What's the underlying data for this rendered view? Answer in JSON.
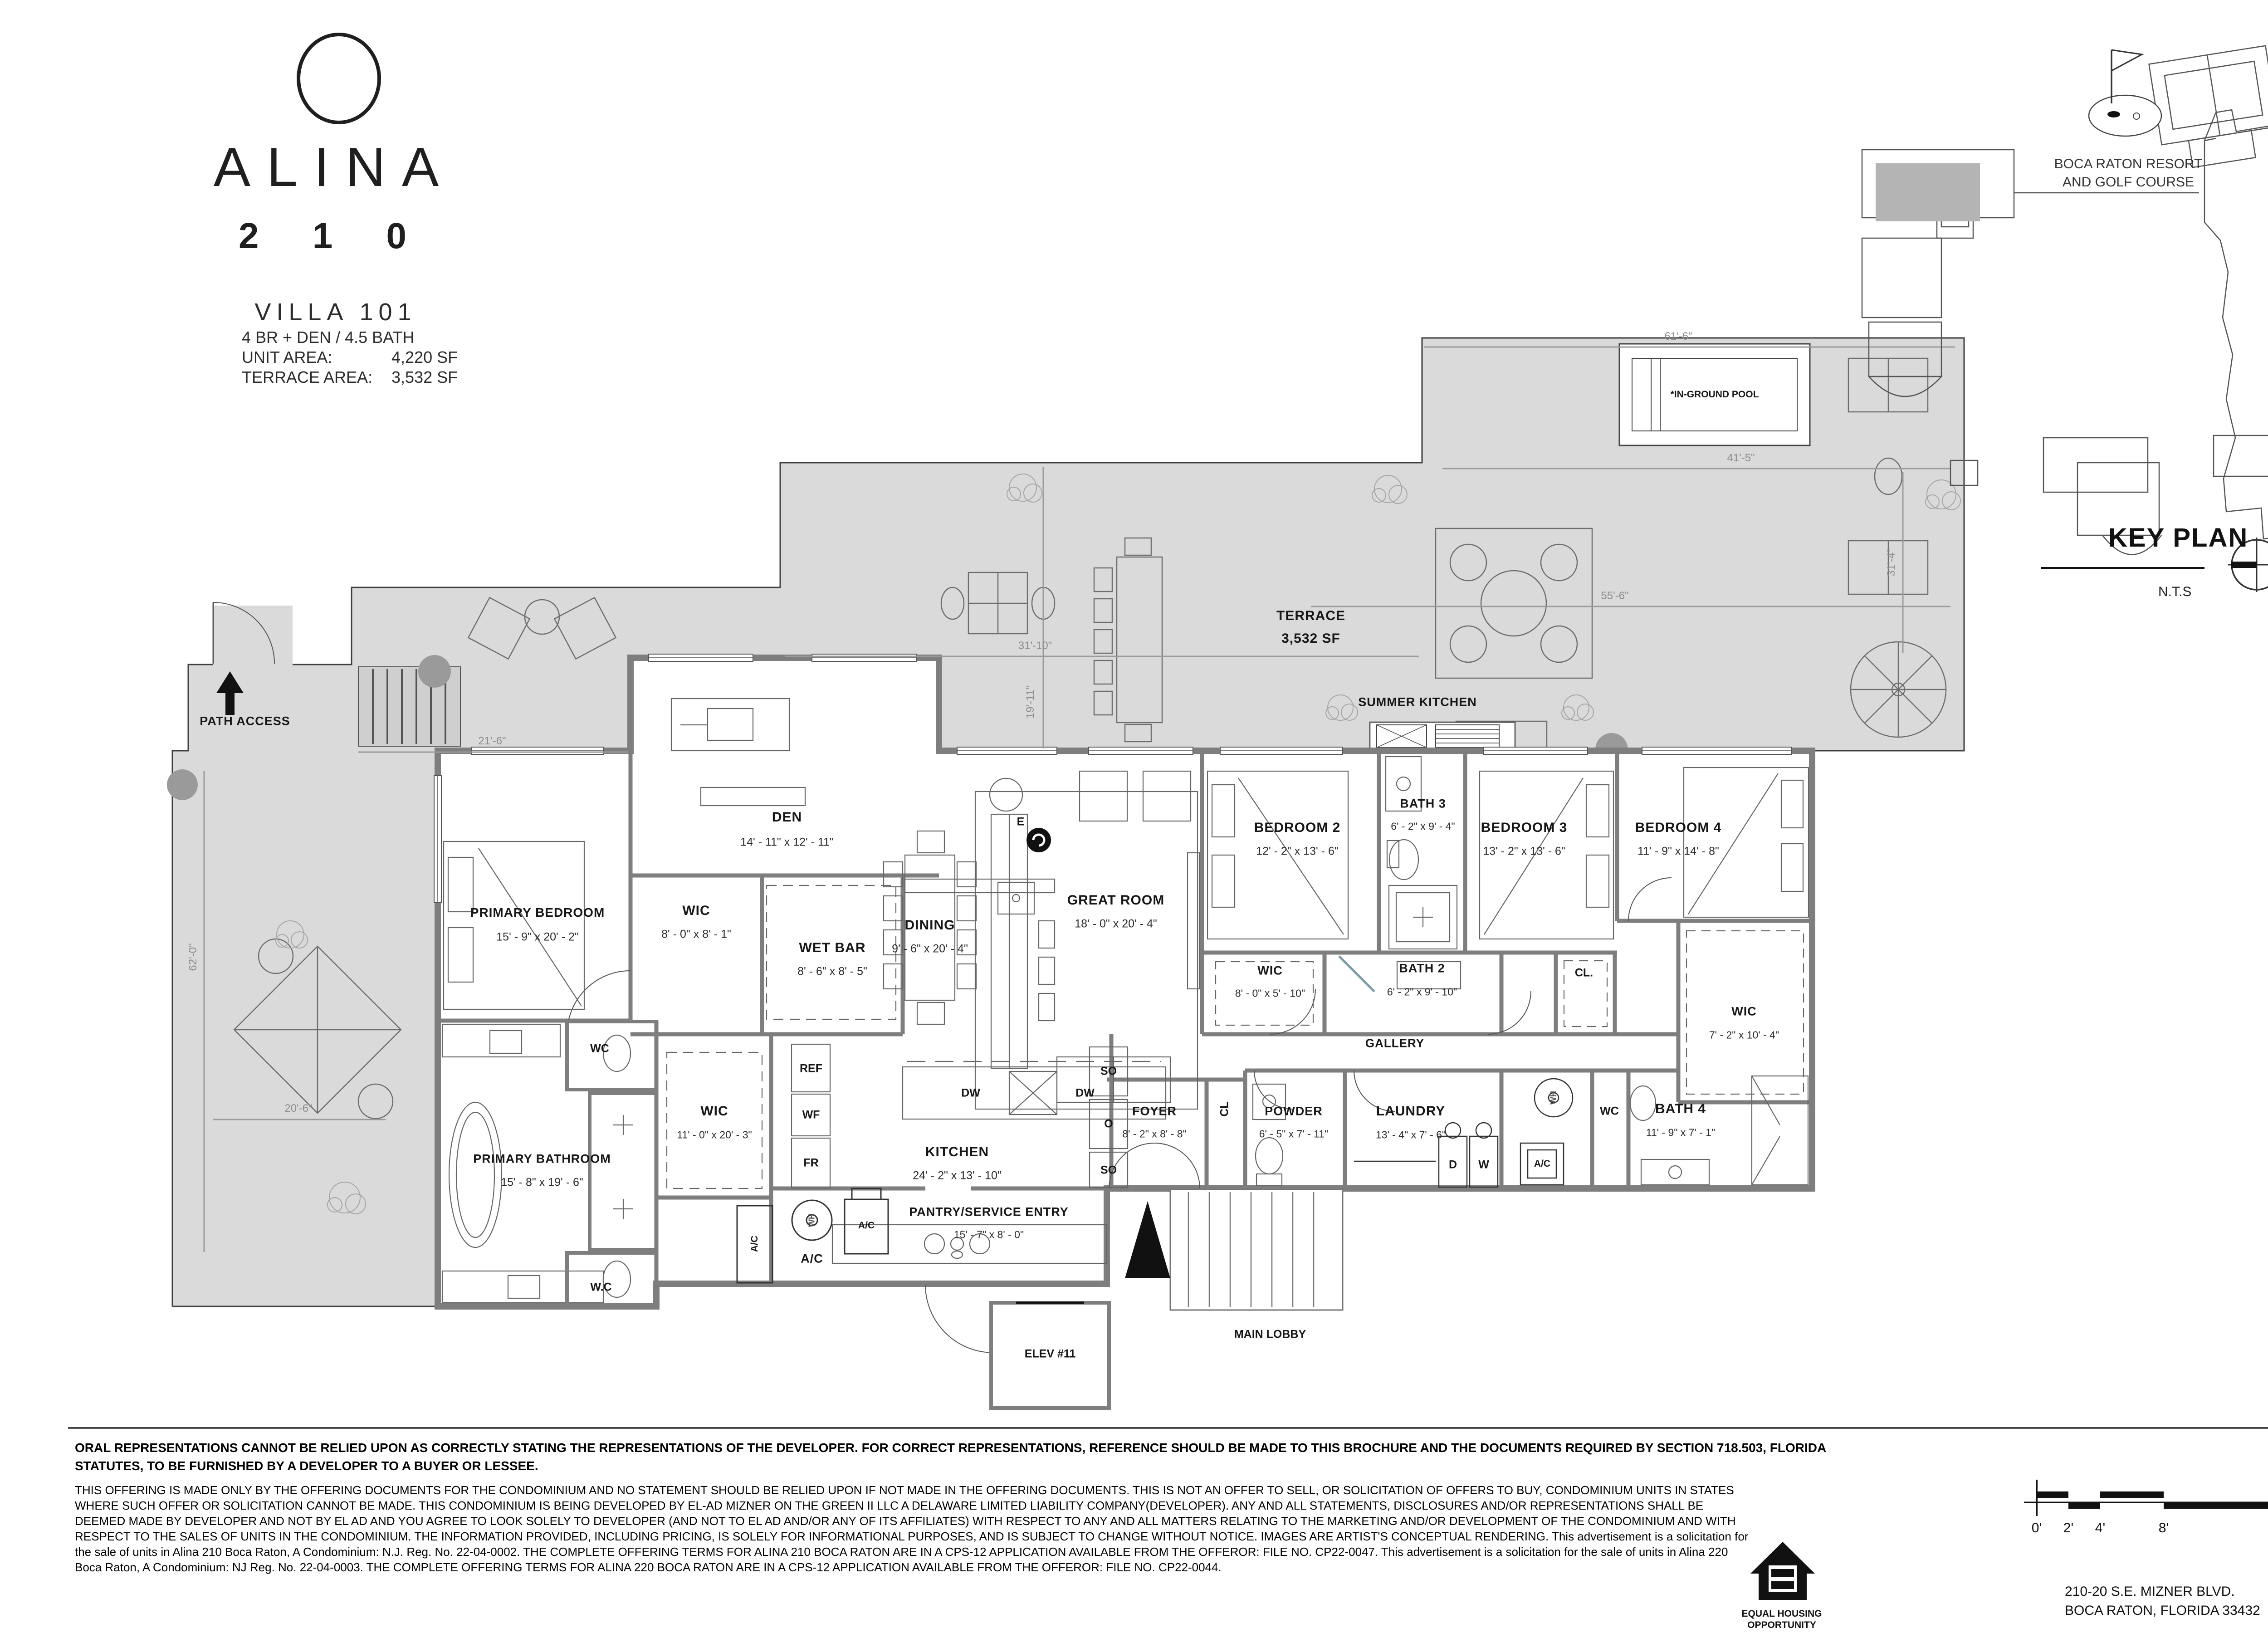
{
  "branding": {
    "name": "ALINA",
    "number": "2 1 0",
    "unit": "VILLA 101",
    "spec_line": "4 BR + DEN / 4.5 BATH",
    "unit_area_label": "UNIT AREA:",
    "unit_area_value": "4,220 SF",
    "terrace_area_label": "TERRACE AREA:",
    "terrace_area_value": "3,532 SF"
  },
  "key_plan": {
    "title": "KEY PLAN",
    "scale_note": "N.T.S",
    "resort_line1": "BOCA RATON RESORT",
    "resort_line2": "AND GOLF COURSE"
  },
  "plan": {
    "rooms": [
      {
        "name": "DEN",
        "dims": "14' - 11\" x 12' - 11\""
      },
      {
        "name": "PRIMARY BEDROOM",
        "dims": "15' - 9\" x 20' - 2\""
      },
      {
        "name": "WIC",
        "dims": "8' - 0\" x 8' - 1\""
      },
      {
        "name": "WET BAR",
        "dims": "8' - 6\" x 8' - 5\""
      },
      {
        "name": "DINING",
        "dims": "9' - 6\" x 20' - 4\""
      },
      {
        "name": "GREAT ROOM",
        "dims": "18' - 0\" x 20' - 4\""
      },
      {
        "name": "BEDROOM 2",
        "dims": "12' - 2\" x 13' - 6\""
      },
      {
        "name": "BATH 3",
        "dims": "6' - 2\" x 9' - 4\""
      },
      {
        "name": "BEDROOM 3",
        "dims": "13' - 2\" x 13' - 6\""
      },
      {
        "name": "BEDROOM 4",
        "dims": "11' - 9\" x 14' - 8\""
      },
      {
        "name": "WIC",
        "dims": "8' - 0\" x 5' - 10\""
      },
      {
        "name": "BATH 2",
        "dims": "6' - 2\" x 9' - 10\""
      },
      {
        "name": "WIC",
        "dims": "7' - 2\" x 10' - 4\""
      },
      {
        "name": "KITCHEN",
        "dims": "24' - 2\" x 13' - 10\""
      },
      {
        "name": "PRIMARY BATHROOM",
        "dims": "15' - 8\" x 19' - 6\""
      },
      {
        "name": "WIC",
        "dims": "11' - 0\" x 20' - 3\""
      },
      {
        "name": "FOYER",
        "dims": "8' - 2\" x 8' - 8\""
      },
      {
        "name": "POWDER",
        "dims": "6' - 5\" x 7' - 11\""
      },
      {
        "name": "LAUNDRY",
        "dims": "13' - 4\" x 7' - 6\""
      },
      {
        "name": "BATH 4",
        "dims": "11' - 9\" x 7' - 1\""
      },
      {
        "name": "PANTRY/SERVICE ENTRY",
        "dims": "15' - 7\" x 8' - 0\""
      }
    ],
    "labels": {
      "terrace_name": "TERRACE",
      "terrace_area": "3,532 SF",
      "pool": "*IN-GROUND POOL",
      "summer_kitchen": "SUMMER KITCHEN",
      "path_access": "PATH ACCESS",
      "gallery": "GALLERY",
      "cl_closet": "CL.",
      "cl_foyer": "CL",
      "wc_top": "WC",
      "wc_bottom": "W.C",
      "wc_hall": "WC",
      "dryer": "D",
      "washer": "W",
      "ac_laundry": "A/C",
      "wh_laundry": "WH",
      "ac_mech_box": "A/C",
      "ac_mech": "A/C",
      "wh_mech": "WH",
      "ac_pantry": "A/C",
      "ref": "REF",
      "wf": "WF",
      "fr": "FR",
      "dw_left": "DW",
      "dw_right": "DW",
      "so_top": "SO",
      "oven": "O",
      "so_bottom": "SO",
      "elevator": "ELEV #11",
      "main_lobby": "MAIN LOBBY",
      "electric": "E"
    },
    "dims": {
      "d21_6": "21'-6\"",
      "d31_10": "31'-10\"",
      "d19_11": "19'-11\"",
      "d41_5": "41'-5\"",
      "d55_6": "55'-6\"",
      "d31_4": "31'-4\"",
      "d61_6": "61'-6\"",
      "d62_0": "62'-0\"",
      "d20_6": "20'-6\""
    }
  },
  "footer": {
    "disclaimer_bold_line1": "ORAL REPRESENTATIONS CANNOT BE RELIED UPON AS CORRECTLY STATING THE REPRESENTATIONS OF THE DEVELOPER. FOR CORRECT REPRESENTATIONS, REFERENCE SHOULD BE MADE TO THIS BROCHURE AND THE DOCUMENTS REQUIRED BY SECTION 718.503, FLORIDA",
    "disclaimer_bold_line2": "STATUTES, TO BE FURNISHED BY A DEVELOPER TO A BUYER OR LESSEE.",
    "body_line1": "THIS OFFERING IS MADE ONLY BY THE OFFERING DOCUMENTS FOR THE CONDOMINIUM AND NO STATEMENT SHOULD BE RELIED UPON IF NOT MADE IN THE OFFERING DOCUMENTS. THIS IS NOT AN OFFER TO SELL, OR SOLICITATION OF OFFERS TO BUY, CONDOMINIUM UNITS IN STATES",
    "body_line2": "WHERE SUCH OFFER OR SOLICITATION CANNOT BE MADE. THIS CONDOMINIUM IS BEING DEVELOPED BY EL-AD MIZNER ON THE GREEN II LLC A DELAWARE LIMITED LIABILITY COMPANY(DEVELOPER). ANY AND ALL STATEMENTS, DISCLOSURES AND/OR REPRESENTATIONS SHALL BE",
    "body_line3": "DEEMED MADE BY DEVELOPER AND NOT BY EL AD AND YOU AGREE TO LOOK SOLELY TO DEVELOPER (AND NOT TO EL AD AND/OR ANY OF ITS AFFILIATES) WITH RESPECT TO ANY AND ALL MATTERS RELATING TO THE MARKETING AND/OR DEVELOPMENT OF THE CONDOMINIUM AND WITH",
    "body_line4": "RESPECT TO THE SALES OF UNITS IN THE CONDOMINIUM. THE INFORMATION PROVIDED, INCLUDING PRICING, IS SOLELY FOR INFORMATIONAL PURPOSES, AND IS SUBJECT TO CHANGE WITHOUT NOTICE. IMAGES ARE ARTIST'S CONCEPTUAL RENDERING. This advertisement is a solicitation for",
    "body_line5": "the sale of units in Alina 210 Boca Raton, A Condominium: N.J. Reg. No. 22-04-0002. THE COMPLETE OFFERING TERMS FOR ALINA 210 BOCA RATON ARE IN A CPS-12 APPLICATION AVAILABLE FROM THE OFFEROR: FILE NO. CP22-0047.  This advertisement is a solicitation for the sale of units in Alina 220",
    "body_line6": "Boca Raton, A Condominium: NJ Reg. No. 22-04-0003.  THE COMPLETE OFFERING TERMS FOR ALINA 220 BOCA RATON ARE IN A CPS-12 APPLICATION AVAILABLE FROM THE OFFEROR: FILE NO. CP22-0044.",
    "equal_housing_line1": "EQUAL HOUSING",
    "equal_housing_line2": "OPPORTUNITY",
    "scale_ticks": [
      "0'",
      "2'",
      "4'",
      "8'",
      "16'"
    ],
    "address_line1": "210-20 S.E. MIZNER BLVD.",
    "address_line2": "BOCA RATON, FLORIDA 33432"
  }
}
